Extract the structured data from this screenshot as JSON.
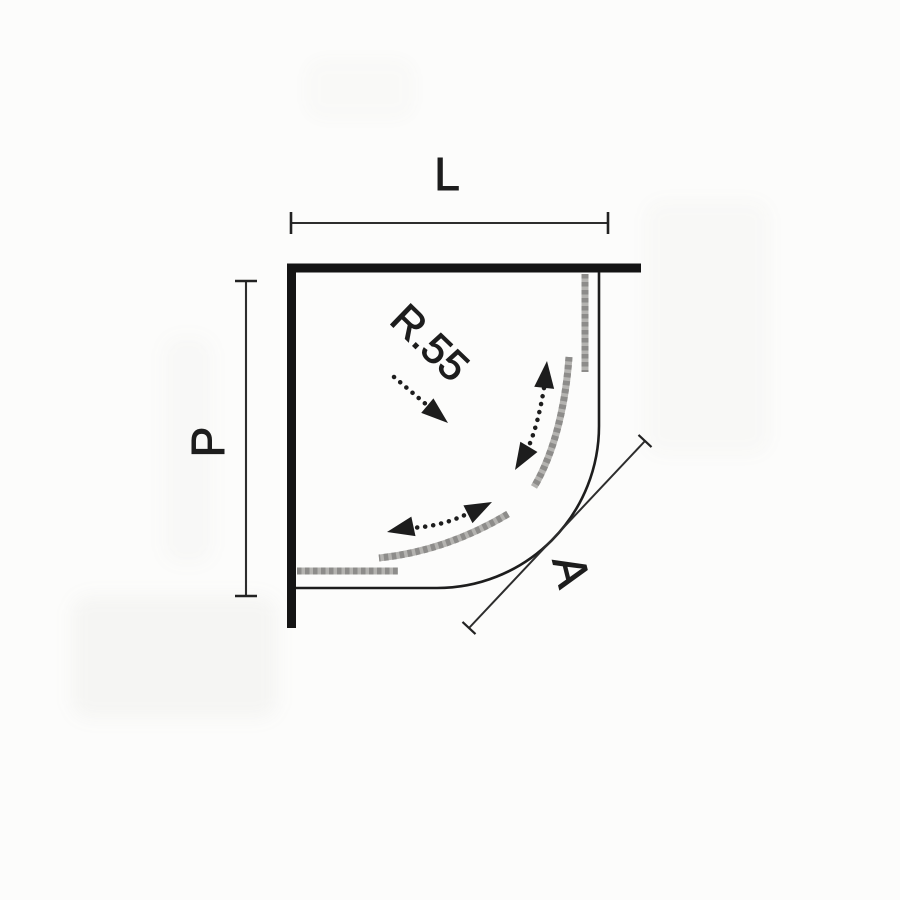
{
  "diagram": {
    "description": "Top-view dimension diagram of a quadrant corner shower enclosure with two fixed panels and two curved sliding doors",
    "labels": {
      "width": "L",
      "depth": "P",
      "front": "A",
      "radius": "R.55"
    },
    "colors": {
      "ink": "#1d1d1d",
      "wall": "#141414",
      "glassLight": "#b4b3b0",
      "glassDark": "#8d8c8a",
      "background": "#fcfcfb"
    }
  }
}
